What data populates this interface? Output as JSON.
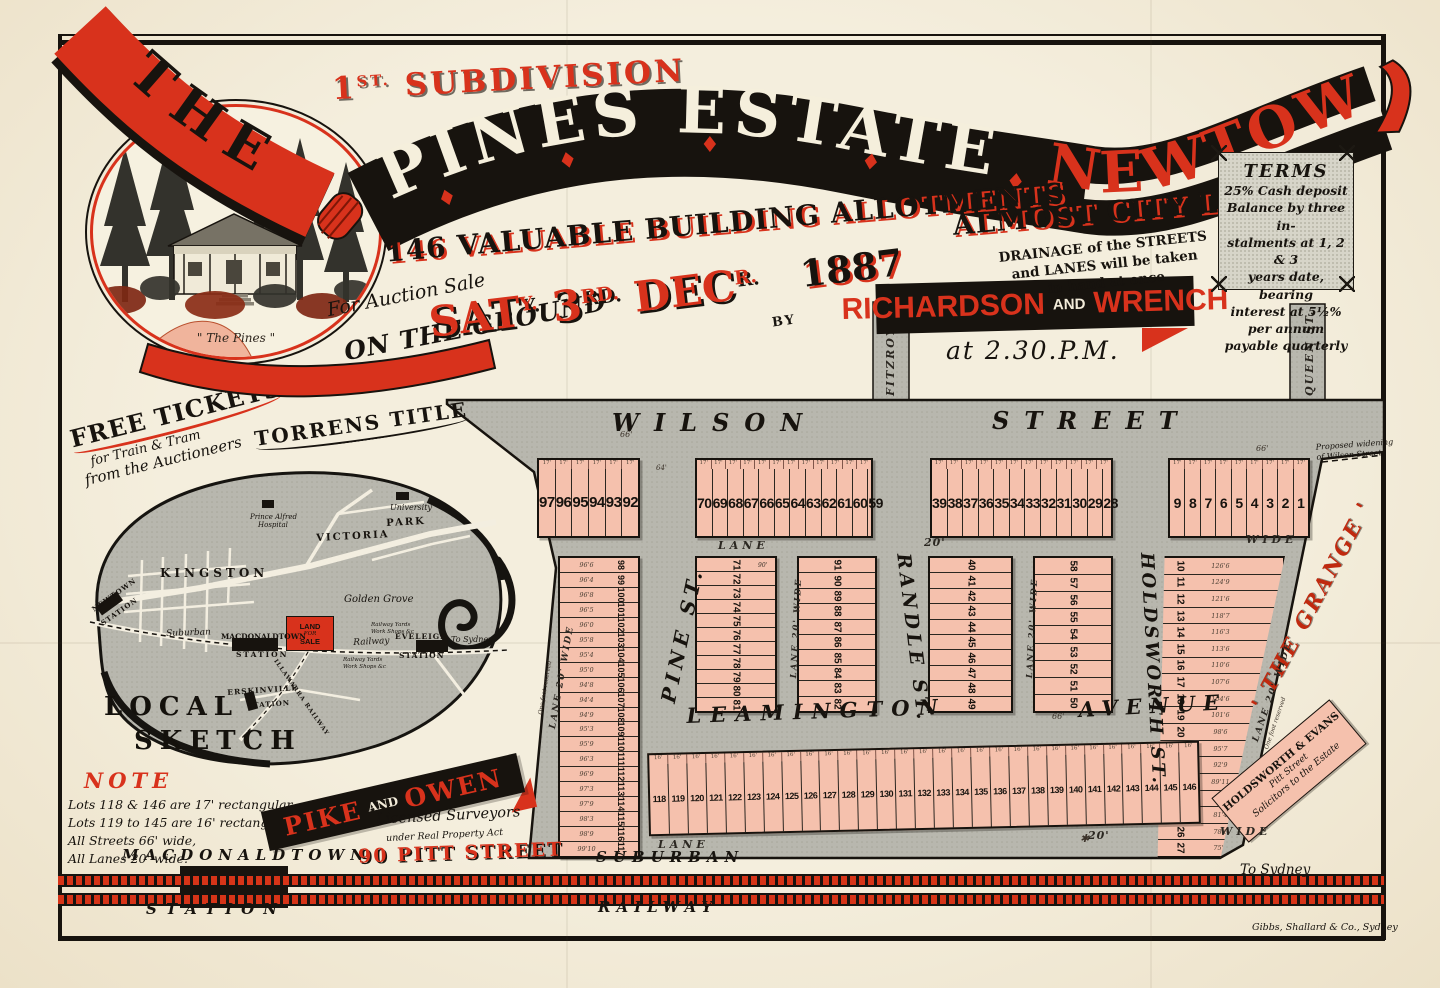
{
  "colors": {
    "red": "#d8321c",
    "ink": "#17130e",
    "map_gray": "#b8b7ae",
    "lot_pink": "#f5c1ad",
    "paper": "#f2ebd9",
    "terms_gray": "#d7d5c9"
  },
  "header": {
    "the": "THE",
    "subdivision_no": "1",
    "subdivision_sup": "ST.",
    "subdivision_word": "SUBDIVISION",
    "estate": "PINES ESTATE",
    "newtown": "NEWTOWN",
    "allotments": "146 VALUABLE BUILDING ALLOTMENTS",
    "almost": "ALMOST CITY LAND",
    "for_auction": "For Auction Sale",
    "on_ground": "ON THE GROUND",
    "sat": "SAT",
    "sat_sup": "Y.",
    "day": "3",
    "day_sup": "RD.",
    "month": "DEC",
    "month_sup": "R.",
    "year": "1887",
    "by": "BY",
    "auctioneer_1": "RICHARDSON",
    "auctioneer_and": "AND",
    "auctioneer_2": "WRENCH",
    "time": "at 2.30.P.M.",
    "drainage_lines": [
      "DRAINAGE of the STREETS",
      "and LANES will be taken",
      "in hand at once"
    ],
    "vignette_caption": "\" The Pines \""
  },
  "terms": {
    "title": "TERMS",
    "lines": [
      "25% Cash deposit",
      "Balance by three in-",
      "stalments at 1, 2 & 3",
      "years date, bearing",
      "interest at 5½% per annum",
      "payable quarterly"
    ]
  },
  "promo": {
    "free1": "FREE TICKETS",
    "free2": "for Train & Tram",
    "free3": "from the Auctioneers",
    "torrens": "TORRENS TITLE"
  },
  "sketch": {
    "title1": "LOCAL",
    "title2": "SKETCH",
    "land_sale": [
      "LAND",
      "FOR",
      "SALE"
    ],
    "labels": [
      {
        "t": "University",
        "x": 390,
        "y": 503,
        "fs": 8,
        "cls": "sk-i"
      },
      {
        "t": "Prince Alfred",
        "x": 250,
        "y": 513,
        "fs": 7,
        "cls": "sk-i"
      },
      {
        "t": "Hospital",
        "x": 258,
        "y": 521,
        "fs": 7,
        "cls": "sk-i"
      },
      {
        "t": "VICTORIA",
        "x": 316,
        "y": 533,
        "fs": 10,
        "ls": 2,
        "rot": -3,
        "cls": "sk-b"
      },
      {
        "t": "PARK",
        "x": 386,
        "y": 518,
        "fs": 10,
        "ls": 2,
        "rot": -3,
        "cls": "sk-b"
      },
      {
        "t": "KINGSTON",
        "x": 160,
        "y": 566,
        "fs": 12,
        "ls": 4,
        "cls": "sk-b"
      },
      {
        "t": "NEWTOWN",
        "x": 90,
        "y": 606,
        "fs": 7,
        "ls": 1,
        "rot": -35,
        "cls": "sk-b"
      },
      {
        "t": "STATION",
        "x": 99,
        "y": 620,
        "fs": 7,
        "ls": 1,
        "rot": -35,
        "cls": "sk-b"
      },
      {
        "t": "Golden Grove",
        "x": 344,
        "y": 594,
        "fs": 10,
        "cls": "sk-i"
      },
      {
        "t": "Suburban",
        "x": 166,
        "y": 629,
        "fs": 9,
        "rot": -2,
        "cls": "sk-i"
      },
      {
        "t": "MACDONALDTOWN",
        "x": 221,
        "y": 632,
        "fs": 7.5,
        "cls": "sk-b"
      },
      {
        "t": "STATION",
        "x": 236,
        "y": 650,
        "fs": 7.5,
        "ls": 2,
        "cls": "sk-b"
      },
      {
        "t": "Railway",
        "x": 353,
        "y": 638,
        "fs": 9,
        "rot": -3,
        "cls": "sk-i"
      },
      {
        "t": "Railway Yards",
        "x": 371,
        "y": 622,
        "fs": 5.5,
        "cls": "sk-i"
      },
      {
        "t": "Work Shops &c",
        "x": 371,
        "y": 629,
        "fs": 5.5,
        "cls": "sk-i"
      },
      {
        "t": "EVELEIGH",
        "x": 395,
        "y": 632,
        "fs": 7.5,
        "ls": 1,
        "cls": "sk-b"
      },
      {
        "t": "STATION",
        "x": 399,
        "y": 651,
        "fs": 7.5,
        "ls": 1,
        "cls": "sk-b"
      },
      {
        "t": "To Sydney",
        "x": 451,
        "y": 635,
        "fs": 8,
        "cls": "sk-i"
      },
      {
        "t": "Railway Yards",
        "x": 343,
        "y": 657,
        "fs": 5.5,
        "cls": "sk-i"
      },
      {
        "t": "Work Shops &c",
        "x": 343,
        "y": 664,
        "fs": 5.5,
        "cls": "sk-i"
      },
      {
        "t": "ERSKINVILLE",
        "x": 227,
        "y": 688,
        "fs": 7.5,
        "ls": 1,
        "rot": -4,
        "cls": "sk-b"
      },
      {
        "t": "STATION",
        "x": 247,
        "y": 701,
        "fs": 7,
        "ls": 1,
        "rot": -4,
        "cls": "sk-b"
      },
      {
        "t": "ILLAWARRA RAILWAY",
        "x": 278,
        "y": 658,
        "fs": 6,
        "ls": 1,
        "rot": 55,
        "cls": "sk-b"
      },
      {
        "t": "LOCAL",
        "x": 104,
        "y": 692,
        "fs": 26,
        "ls": 7,
        "cls": "sk-bi"
      },
      {
        "t": "SKETCH",
        "x": 134,
        "y": 726,
        "fs": 26,
        "ls": 7,
        "cls": "sk-bi"
      }
    ]
  },
  "note": {
    "title": "NOTE",
    "lines": [
      "Lots 118 & 146 are 17' rectangular.",
      "Lots 119 to 145 are 16' rectangular.",
      "All Streets 66' wide,",
      "All Lanes 20' wide."
    ]
  },
  "surveyors": {
    "n1": "PIKE",
    "and": "AND",
    "n2": "OWEN",
    "l1": "Licensed Surveyors",
    "l2": "under Real Property Act",
    "addr": "90 PITT STREET"
  },
  "map": {
    "widening": [
      "Proposed widening",
      "of Wilson Street"
    ],
    "grange": "' THE GRANGE '",
    "solicitors": [
      "HOLDSWORTH & EVANS",
      "Pitt Street",
      "Solicitors to the Estate"
    ],
    "to_sydney": "To Sydney",
    "labels": [
      {
        "t": "WILSON",
        "x": 612,
        "y": 408,
        "fs": 24,
        "ls": 15,
        "cls": "st"
      },
      {
        "t": "STREET",
        "x": 992,
        "y": 406,
        "fs": 24,
        "ls": 15,
        "cls": "st"
      },
      {
        "t": "LEAMINGTON",
        "x": 686,
        "y": 703,
        "fs": 21,
        "ls": 9,
        "rot": -2,
        "cls": "st"
      },
      {
        "t": "AVENUE",
        "x": 1078,
        "y": 697,
        "fs": 21,
        "ls": 8,
        "rot": -3,
        "cls": "st"
      },
      {
        "t": "PINE ST.",
        "x": 656,
        "y": 700,
        "rot": -78,
        "fs": 20,
        "ls": 5,
        "cls": "st"
      },
      {
        "t": "RANDLE ST.",
        "x": 914,
        "y": 552,
        "rot": 83,
        "fs": 19,
        "ls": 4,
        "cls": "st"
      },
      {
        "t": "HOLDSWORTH ST.",
        "x": 1157,
        "y": 552,
        "rot": 87,
        "fs": 18,
        "ls": 3,
        "cls": "st"
      },
      {
        "t": "FITZROY ST.",
        "x": 884,
        "y": 396,
        "rot": -90,
        "fs": 11,
        "ls": 2,
        "cls": "stv"
      },
      {
        "t": "QUEEN ST.",
        "x": 1303,
        "y": 396,
        "rot": -90,
        "fs": 11,
        "ls": 2,
        "cls": "stv"
      },
      {
        "t": "LANE",
        "x": 718,
        "y": 539,
        "fs": 11,
        "ls": 4,
        "cls": "ln"
      },
      {
        "t": "20'",
        "x": 924,
        "y": 536,
        "fs": 11,
        "ls": 1,
        "cls": "ln"
      },
      {
        "t": "WIDE",
        "x": 1246,
        "y": 533,
        "fs": 11,
        "ls": 4,
        "cls": "ln"
      },
      {
        "t": "LANE",
        "x": 658,
        "y": 838,
        "fs": 11,
        "ls": 4,
        "cls": "ln"
      },
      {
        "t": "20'",
        "x": 1088,
        "y": 829,
        "fs": 11,
        "ls": 1,
        "cls": "ln"
      },
      {
        "t": "WIDE",
        "x": 1220,
        "y": 825,
        "fs": 11,
        "ls": 4,
        "cls": "ln"
      },
      {
        "t": "LANE 20' WIDE",
        "x": 789,
        "y": 678,
        "rot": -87,
        "fs": 8.5,
        "ls": 2,
        "cls": "ln"
      },
      {
        "t": "LANE 20' WIDE",
        "x": 1025,
        "y": 678,
        "rot": -87,
        "fs": 8.5,
        "ls": 2,
        "cls": "ln"
      },
      {
        "t": "LANE 20' WIDE",
        "x": 548,
        "y": 728,
        "rot": -80,
        "fs": 9,
        "ls": 2,
        "cls": "ln"
      },
      {
        "t": "LANE 20' WIDE",
        "x": 1251,
        "y": 740,
        "rot": -71,
        "fs": 9,
        "ls": 2,
        "cls": "ln"
      },
      {
        "t": "One foot reserved",
        "x": 537,
        "y": 714,
        "rot": -80,
        "fs": 6,
        "cls": "tiny"
      },
      {
        "t": "One foot reserved",
        "x": 1263,
        "y": 748,
        "rot": -71,
        "fs": 6,
        "cls": "tiny"
      },
      {
        "t": "66'",
        "x": 620,
        "y": 430,
        "fs": 8,
        "cls": "mk"
      },
      {
        "t": "66'",
        "x": 1052,
        "y": 712,
        "fs": 8,
        "cls": "mk"
      },
      {
        "t": "66'",
        "x": 1256,
        "y": 444,
        "fs": 8,
        "cls": "mk"
      },
      {
        "t": "64'",
        "x": 656,
        "y": 464,
        "fs": 7,
        "cls": "mk"
      },
      {
        "t": "90'",
        "x": 758,
        "y": 562,
        "fs": 6,
        "cls": "mk"
      },
      {
        "t": "✱",
        "x": 1080,
        "y": 832,
        "fs": 11,
        "cls": "mk"
      }
    ],
    "blocks": [
      {
        "name": "wilson-row-west",
        "x": 537,
        "y": 458,
        "w": 103,
        "h": 80,
        "dir": "h",
        "fs": 15,
        "mark": "17'",
        "lots": [
          "97",
          "96",
          "95",
          "94",
          "93",
          "92"
        ]
      },
      {
        "name": "wilson-row-pine-randle",
        "x": 695,
        "y": 458,
        "w": 178,
        "h": 80,
        "dir": "h",
        "fs": 14,
        "mark": "17'",
        "lots": [
          "70",
          "69",
          "68",
          "67",
          "66",
          "65",
          "64",
          "63",
          "62",
          "61",
          "60",
          "59"
        ]
      },
      {
        "name": "wilson-row-randle-holdsworth",
        "x": 930,
        "y": 458,
        "w": 183,
        "h": 80,
        "dir": "h",
        "fs": 14,
        "mark": "17'",
        "lots": [
          "39",
          "38",
          "37",
          "36",
          "35",
          "34",
          "33",
          "32",
          "31",
          "30",
          "29",
          "28"
        ]
      },
      {
        "name": "wilson-row-east",
        "x": 1168,
        "y": 458,
        "w": 142,
        "h": 80,
        "dir": "h",
        "fs": 14,
        "mark": "17'",
        "lots": [
          "9",
          "8",
          "7",
          "6",
          "5",
          "4",
          "3",
          "2",
          "1"
        ]
      },
      {
        "name": "pine-west-column",
        "x": 558,
        "y": 556,
        "w": 82,
        "h": 302,
        "dir": "v",
        "fs": 9,
        "numSide": "right",
        "lots": [
          "98",
          "99",
          "100",
          "101",
          "102",
          "103",
          "104",
          "105",
          "106",
          "107",
          "108",
          "109",
          "110",
          "111",
          "112",
          "113",
          "114",
          "115",
          "116",
          "117"
        ],
        "dims": [
          "96'6",
          "96'4",
          "96'8",
          "96'5",
          "96'0",
          "95'8",
          "95'4",
          "95'0",
          "94'8",
          "94'4",
          "94'9",
          "95'3",
          "95'9",
          "96'3",
          "96'9",
          "97'3",
          "97'9",
          "98'3",
          "98'9",
          "99'10"
        ]
      },
      {
        "name": "pine-lane-block",
        "x": 695,
        "y": 556,
        "w": 82,
        "h": 157,
        "dir": "v",
        "fs": 10,
        "lots": [
          "71",
          "72",
          "73",
          "74",
          "75",
          "76",
          "77",
          "78",
          "79",
          "80",
          "81"
        ]
      },
      {
        "name": "lane-randle-block",
        "x": 797,
        "y": 556,
        "w": 80,
        "h": 157,
        "dir": "v",
        "fs": 10,
        "lots": [
          "91",
          "90",
          "89",
          "88",
          "87",
          "86",
          "85",
          "84",
          "83",
          "82"
        ]
      },
      {
        "name": "randle-lane-block",
        "x": 928,
        "y": 556,
        "w": 85,
        "h": 157,
        "dir": "v",
        "fs": 10,
        "lots": [
          "40",
          "41",
          "42",
          "43",
          "44",
          "45",
          "46",
          "47",
          "48",
          "49"
        ]
      },
      {
        "name": "lane-holdsworth-block",
        "x": 1033,
        "y": 556,
        "w": 80,
        "h": 157,
        "dir": "v",
        "fs": 10,
        "lots": [
          "58",
          "57",
          "56",
          "55",
          "54",
          "53",
          "52",
          "51",
          "50"
        ]
      },
      {
        "name": "grange-east-column",
        "x": 1145,
        "y": 556,
        "w": 140,
        "h": 302,
        "dir": "v",
        "fs": 10,
        "numSide": "left",
        "clip": "polygon(14% 0%,100% 0%,54% 100%,9% 100%)",
        "lots": [
          "10",
          "11",
          "12",
          "13",
          "14",
          "15",
          "16",
          "17",
          "18",
          "19",
          "20",
          "21",
          "22",
          "23",
          "24",
          "25",
          "26",
          "27"
        ],
        "dims": [
          "126'6",
          "124'9",
          "121'6",
          "118'7",
          "116'3",
          "113'6",
          "110'6",
          "107'6",
          "104'6",
          "101'6",
          "98'6",
          "95'7",
          "92'9",
          "89'11",
          "84'3",
          "81'4",
          "78'6",
          "75'5"
        ]
      },
      {
        "name": "leamington-row",
        "x": 648,
        "y": 747,
        "w": 552,
        "h": 83,
        "dir": "h",
        "fs": 9,
        "rot": -1.3,
        "mark": "16'",
        "lots": [
          "118",
          "119",
          "120",
          "121",
          "122",
          "123",
          "124",
          "125",
          "126",
          "127",
          "128",
          "129",
          "130",
          "131",
          "132",
          "133",
          "134",
          "135",
          "136",
          "137",
          "138",
          "139",
          "140",
          "141",
          "142",
          "143",
          "144",
          "145",
          "146"
        ]
      }
    ]
  },
  "railway": {
    "macdonaldtown": "MACDONALDTOWN",
    "station": "STATION",
    "suburban": "SUBURBAN",
    "railway": "RAILWAY"
  },
  "printer": "Gibbs, Shallard & Co., Sydney"
}
